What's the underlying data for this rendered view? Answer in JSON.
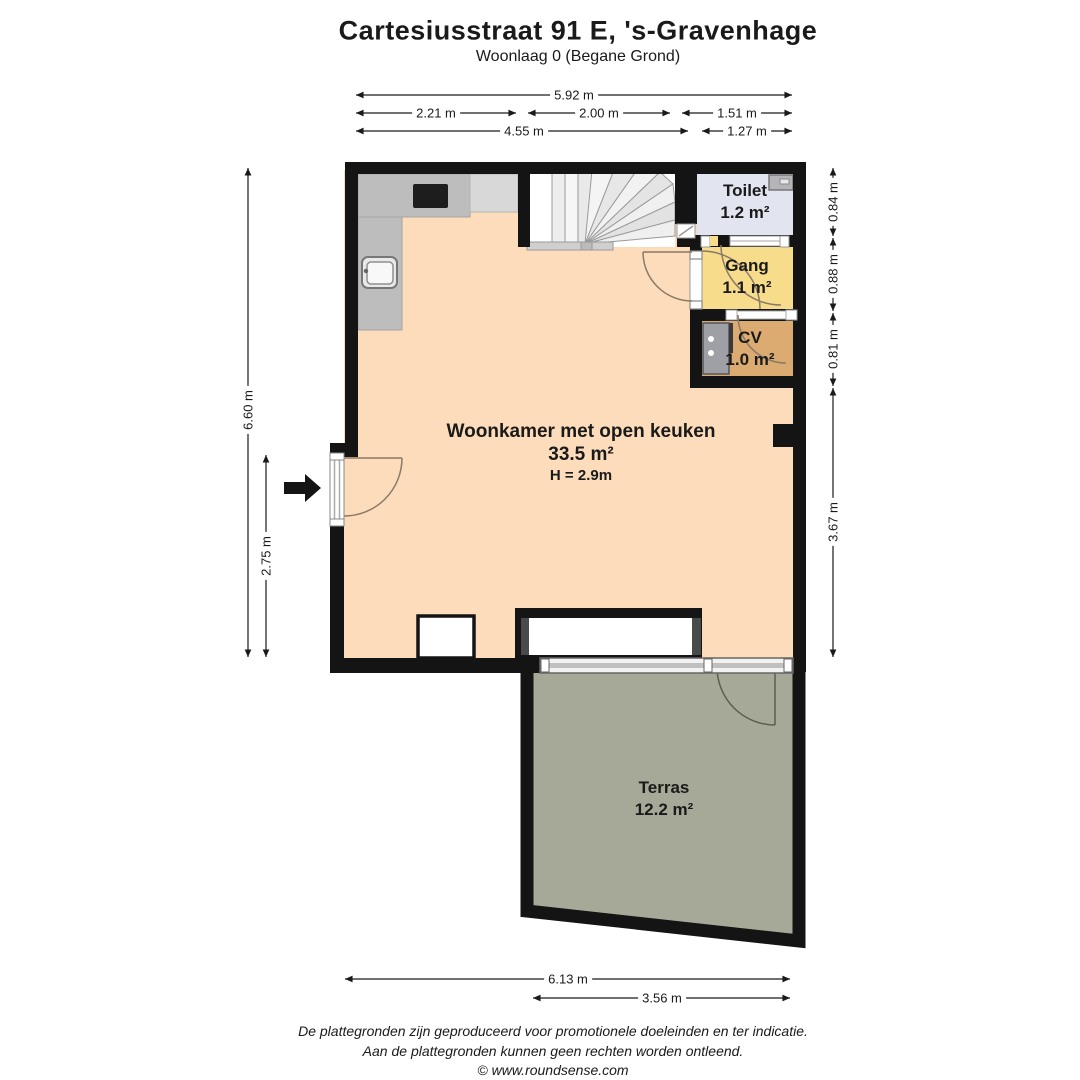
{
  "title": "Cartesiusstraat 91 E, 's-Gravenhage",
  "subtitle": "Woonlaag 0 (Begane Grond)",
  "rooms": {
    "woonkamer": {
      "name": "Woonkamer met open keuken",
      "area": "33.5 m²",
      "height": "H = 2.9m"
    },
    "toilet": {
      "name": "Toilet",
      "area": "1.2 m²"
    },
    "gang": {
      "name": "Gang",
      "area": "1.1 m²"
    },
    "cv": {
      "name": "CV",
      "area": "1.0 m²"
    },
    "terras": {
      "name": "Terras",
      "area": "12.2 m²"
    }
  },
  "dimensions": {
    "top_total": "5.92 m",
    "top_left": "2.21 m",
    "top_mid": "2.00 m",
    "top_right": "1.51 m",
    "top_sub_left": "4.55 m",
    "top_sub_right": "1.27 m",
    "left_total": "6.60 m",
    "left_lower": "2.75 m",
    "right_top": "0.84 m",
    "right_mid": "0.88 m",
    "right_low": "0.81 m",
    "right_main": "3.67 m",
    "bottom_total": "6.13 m",
    "bottom_terras": "3.56 m"
  },
  "footer": {
    "line1": "De plattegronden zijn geproduceerd voor promotionele doeleinden en ter indicatie.",
    "line2": "Aan de plattegronden kunnen geen rechten worden ontleend.",
    "line3": "© www.roundsense.com"
  },
  "colors": {
    "wall": "#141414",
    "woonkamer": "#fcdcba",
    "toilet": "#e2e4ef",
    "gang": "#f7dd8b",
    "cv": "#dcab72",
    "terras": "#a6a997",
    "counter": "#bdbdbd",
    "counter_light": "#d8d8d8",
    "dimension": "#1a1a1a"
  }
}
